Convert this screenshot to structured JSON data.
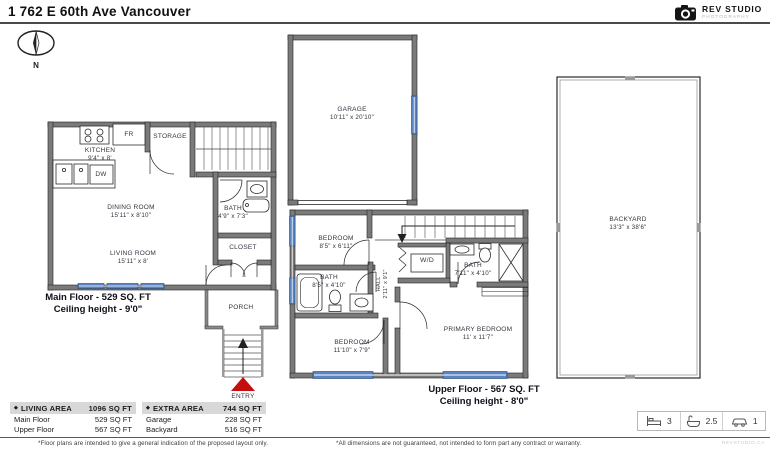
{
  "header": {
    "title": "1 762 E 60th Ave Vancouver",
    "logo_name": "REV STUDIO",
    "logo_sub": "PHOTOGRAPHY",
    "compass": "N"
  },
  "main_floor": {
    "caption1": "Main Floor - 529 SQ. FT",
    "caption2": "Ceiling height - 9'0\"",
    "kitchen_name": "KITCHEN",
    "kitchen_dims": "9'4\" x 8'",
    "storage": "STORAGE",
    "fr": "FR",
    "dw": "DW",
    "dining_name": "DINING ROOM",
    "dining_dims": "15'11\" x 8'10\"",
    "living_name": "LIVING ROOM",
    "living_dims": "15'11\" x 8'",
    "bath_name": "BATH",
    "bath_dims": "4'9\" x 7'3\"",
    "closet": "CLOSET",
    "porch": "PORCH",
    "entry": "ENTRY"
  },
  "garage": {
    "name": "GARAGE",
    "dims": "10'11\" x 20'10\""
  },
  "upper_floor": {
    "caption1": "Upper Floor - 567 SQ. FT",
    "caption2": "Ceiling height - 8'0\"",
    "bedroom1_name": "BEDROOM",
    "bedroom1_dims": "8'5\" x 6'11\"",
    "bath_left_name": "BATH",
    "bath_left_dims": "8'5\" x 4'10\"",
    "hall_name": "HALL",
    "hall_dims": "2'11\" x 9'1\"",
    "wd": "W/D",
    "bath_right_name": "BATH",
    "bath_right_dims": "7'11\" x 4'10\"",
    "bedroom2_name": "BEDROOM",
    "bedroom2_dims": "11'10\" x 7'9\"",
    "primary_name": "PRIMARY BEDROOM",
    "primary_dims": "11' x 11'7\""
  },
  "backyard": {
    "name": "BACKYARD",
    "dims": "13'3\" x 38'6\""
  },
  "summary": {
    "living": {
      "header": "LIVING AREA",
      "total": "1096 SQ FT",
      "rows": [
        {
          "label": "Main Floor",
          "value": "529 SQ FT"
        },
        {
          "label": "Upper Floor",
          "value": "567 SQ FT"
        }
      ]
    },
    "extra": {
      "header": "EXTRA AREA",
      "total": "744 SQ FT",
      "rows": [
        {
          "label": "Garage",
          "value": "228 SQ FT"
        },
        {
          "label": "Backyard",
          "value": "516 SQ FT"
        }
      ]
    }
  },
  "features": {
    "beds": "3",
    "baths": "2.5",
    "parking": "1"
  },
  "footer": {
    "left": "*Floor plans are intended to give a general indication of the proposed layout only.",
    "right": "*All dimensions are not guaranteed, not intended to form part any contract or warranty.",
    "site": "REVSTUDIO.CA"
  },
  "colors": {
    "wall": "#7a7a7a",
    "window": "#5b84c4",
    "entry_arrow": "#c40f0f"
  }
}
